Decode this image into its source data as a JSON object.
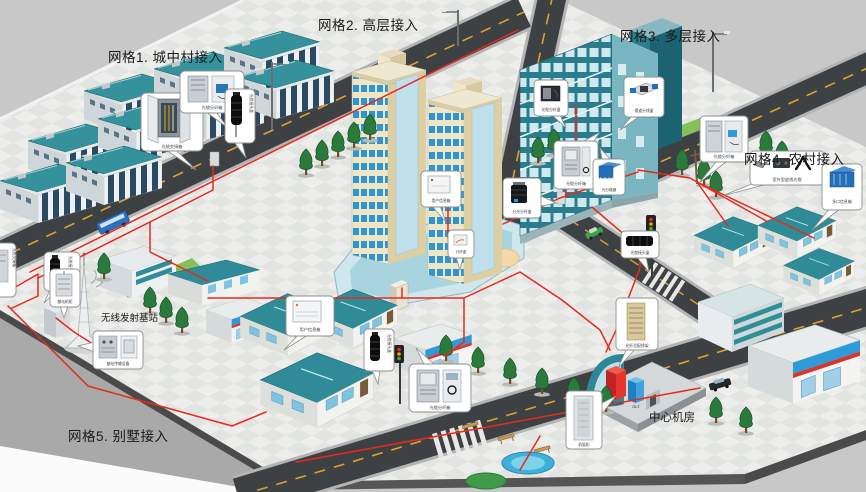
{
  "scene": {
    "background_color": "#c8c8c8",
    "cable_color": "#e8291c",
    "road_color": "#3e4144",
    "roof_teal": "#2e8b97",
    "tower_cream": "#e9dcb8",
    "window_blue": "#2f95d2"
  },
  "labels": {
    "grid1": "网格1. 城中村接入",
    "grid2": "网格2. 高层接入",
    "grid3": "网格3. 多层接入",
    "grid4": "网格4. 农村接入",
    "grid5": "网格5. 别墅接入",
    "base_station": "无线发射基站",
    "central_office": "中心机房"
  },
  "racks": {
    "omdf": "OMDF",
    "olt": "OLT"
  },
  "callouts": {
    "g1_cross": "光缆交接箱",
    "g1_dist": "光缆分纤箱",
    "g1_splice": "光缆接头盒",
    "left_splice": "光缆接头盒",
    "edge_cab": "光缆交接箱",
    "bts_cab": "基站机柜",
    "bts_eq": "基站传输设备",
    "villa_info": "用户信息箱",
    "villa_splice": "光缆接头盒",
    "south_dist": "光缆分纤箱",
    "tower_info": "用户信息箱",
    "tower_term": "分纤盒",
    "road_split": "分光分纤盒",
    "g3_dist_cab": "光缆分纤箱",
    "g3_dist_box": "光缆分纤盒",
    "g3_hall": "楼道分线盒",
    "g3_splitter": "光分路器",
    "g4_dist": "光缆分纤箱",
    "g4_drop": "室外型皮线光缆",
    "g4_multi": "多口信息箱",
    "mid_splice": "光缆接头盒",
    "odf": "光纤总配线架",
    "rack": "机架柜"
  }
}
